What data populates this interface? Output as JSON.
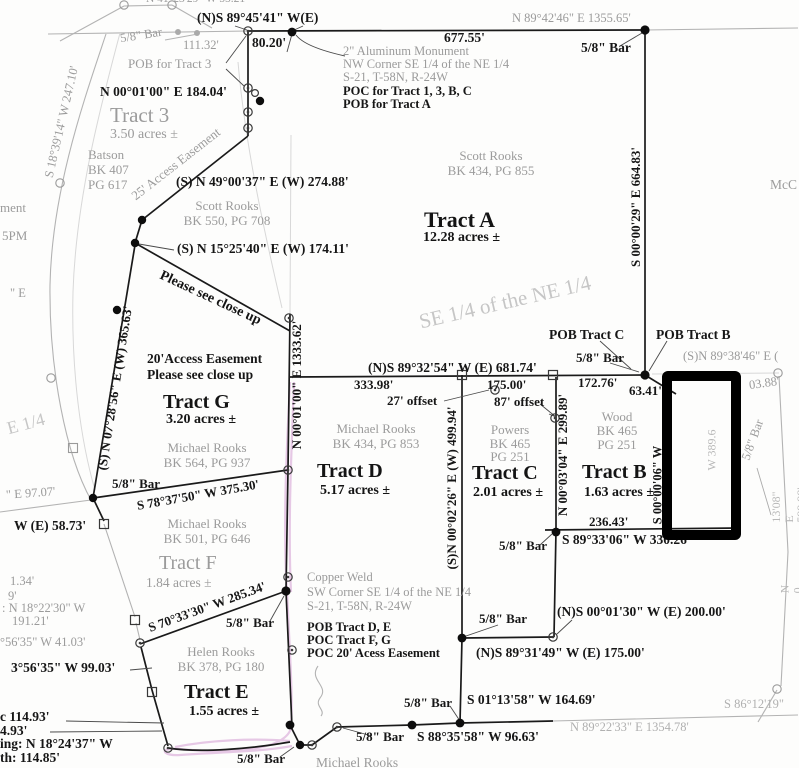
{
  "colors": {
    "boundary_black": "#1a1a1a",
    "adjoiner_grey": "#9b9b9b",
    "watermark_grey": "#c6c6c6",
    "highlight_pink": "#e2bfe2",
    "annotation_rectangle": "#000000"
  },
  "labels": {
    "n41": "N 41°23'29\" W  55.21'",
    "ns894541": "(N)S 89°45'41\" W(E)",
    "d8020": "80.20'",
    "bar_tl": "5/8\" Bar",
    "d11132": "111.32'",
    "d67755": "677.55'",
    "n894246": "N 89°42'46\" E  1355.65'",
    "bar_tr": "5/8\" Bar",
    "monument_grey": "2\" Aluminum Monument\nNW Corner SE 1/4 of the NE 1/4\nS-21, T-58N, R-24W",
    "monument_black": "POC for Tract 1, 3, B, C\nPOB for Tract A",
    "pob_tract3": "POB for Tract 3",
    "n000100_184": "N 00°01'00\" E  184.04'",
    "tract3": "Tract 3",
    "tract3_acres": "3.50 acres ±",
    "batson": "Batson\nBK 407\nPG 617",
    "s183914": "S 18°39'14\" W 247.10'",
    "access25": "25' Access Easement",
    "frag_ment": "ment",
    "frag_5pm": "5PM",
    "s490037": "(S) N 49°00'37\" E (W) 274.88'",
    "scott_550": "Scott Rooks\nBK 550, PG 708",
    "s152540": "(S) N 15°25'40\" E (W) 174.11'",
    "please_diag": "Please see close up",
    "access20": "20'Access Easement\nPlease see close up",
    "scott_434": "Scott Rooks\nBK 434, PG 855",
    "tract_a": "Tract A",
    "tract_a_acres": "12.28 acres ±",
    "se14": "SE 1/4 of the NE 1/4",
    "s000029": "S 00°00'29\" E  664.83'",
    "mcc": "McC",
    "ns893254": "(N)S 89°32'54\" W (E) 681.74'",
    "d33398": "333.98'",
    "d17500": "175.00'",
    "offset27": "27' offset",
    "offset87": "87' offset",
    "pob_c": "POB Tract C",
    "pob_b": "POB Tract B",
    "bar_c": "5/8\" Bar",
    "d17276": "172.76'",
    "d6341": "63.41'",
    "sn893846": "(S)N 89°38'46\" E (",
    "d0388": "03.88'",
    "michael_434": "Michael Rooks\nBK 434, PG 853",
    "tract_d": "Tract D",
    "tract_d_acres": "5.17 acres ±",
    "tract_g": "Tract G",
    "tract_g_acres": "3.20 acres ±",
    "michael_564": "Michael Rooks\nBK 564, PG 937",
    "s783750": "S 78°37'50\" W  375.30'",
    "bar_g": "5/8\" Bar",
    "michael_501": "Michael Rooks\nBK 501, PG 646",
    "tract_f": "Tract F",
    "tract_f_acres": "1.84 acres ±",
    "n000100_1333": "N 00°01'00\" E  1333.62'",
    "s072856": "(S) N 07°28'56\" E (W) 365.63'",
    "w5873": "W (E) 58.73'",
    "e9707": "\" E 97.07'",
    "frag_e": "\" E",
    "e14": "E 1/4",
    "powers": "Powers\nBK 465\nPG 251",
    "tract_c": "Tract C",
    "tract_c_acres": "2.01 acres ±",
    "wood": "Wood\nBK 465\nPG 251",
    "tract_b": "Tract B",
    "tract_b_acres": "1.63 acres ±",
    "sn000226": "(S)N 00°02'26\" E (W) 499.94'",
    "n000304": "N 00°03'04\" E  299.89'",
    "d23643": "236.43'",
    "s893306": "S 89°33'06\" W  330.26'",
    "bar_cb": "5/8\" Bar",
    "s000006": "S 00°00'06\" W",
    "w3896": "W 389.6",
    "bar_rot": "5/8\" Bar",
    "e59998": "13'08\" E  599.98'",
    "frag_n0": "N 0",
    "ns000130": "(N)S 00°01'30\" W (E) 200.00'",
    "bar_d1": "5/8\" Bar",
    "ns893149": "(N)S 89°31'49\" W (E) 175.00'",
    "s011358": "S 01°13'58\" W  164.69'",
    "bar_d2": "5/8\" Bar",
    "s883558": "S 88°35'58\" W  96.63'",
    "bar_b1": "5/8\" Bar",
    "bar_b2": "5/8\" Bar",
    "michael_btm": "Michael Rooks",
    "n892233": "N 89°22'33\" E  1354.78'",
    "s861219": "S 86°12'19\"",
    "copper_grey": "Copper Weld\nSW Corner SE 1/4 of the NE 1/4\nS-21, T-58N, R-24W",
    "copper_black": "POB Tract D, E\nPOC Tract F, G\nPOC 20' Acess Easement",
    "bar_e": "5/8\" Bar",
    "s703330": "S 70°33'30\" W  285.34'",
    "helen": "Helen Rooks\nBK 378, PG 180",
    "tract_e": "Tract E",
    "tract_e_acres": "1.55 acres ±",
    "frag_134": "1.34'",
    "frag_9": "9'",
    "frag_n1822": ": N 18°22'30\" W",
    "frag_19121": "191.21'",
    "frag_5635_41": "°56'35\" W 41.03'",
    "s035635": "3°56'35\" W  99.03'",
    "frag_c11493": "c 114.93'",
    "frag_493": "4.93'",
    "frag_bearing": "ing: N 18°24'37\" W",
    "frag_length": "th: 114.85'"
  }
}
